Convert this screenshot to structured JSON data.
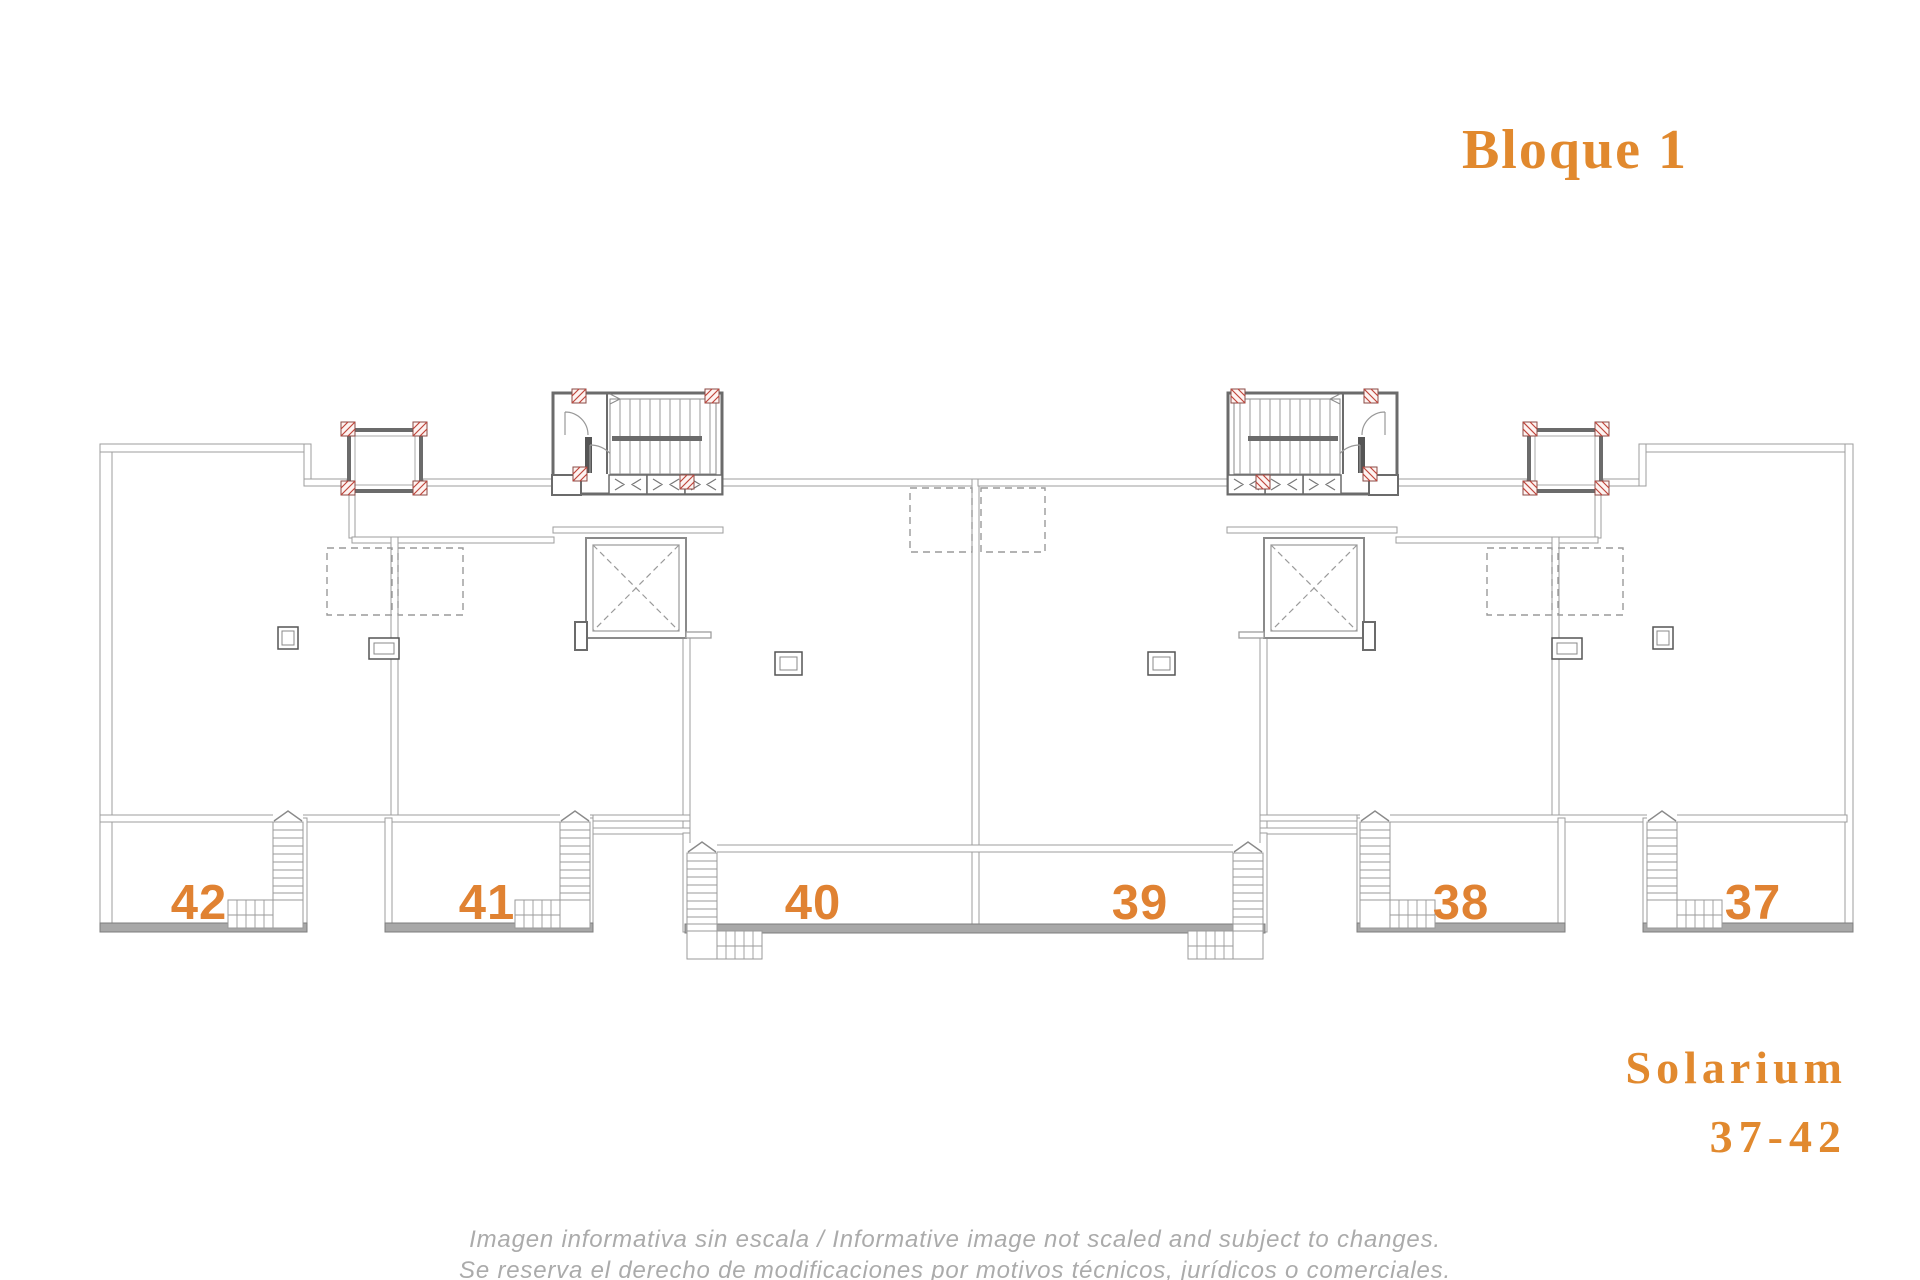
{
  "title_block": {
    "title": "Bloque 1",
    "color": "#E1892E"
  },
  "plan": {
    "units": [
      {
        "number": "42"
      },
      {
        "number": "41"
      },
      {
        "number": "40"
      },
      {
        "number": "39"
      },
      {
        "number": "38"
      },
      {
        "number": "37"
      }
    ],
    "number_color": "#E08232",
    "wall_color": "#9d9d9d",
    "core_wall_color": "#6b6b6b",
    "post_color": "#c0453c"
  },
  "solarium_label": {
    "line1": "Solarium",
    "line2": "37-42",
    "color": "#E1892E"
  },
  "disclaimer": {
    "line1": "Imagen informativa sin escala /  Informative image not scaled and subject to changes.",
    "line2": "Se reserva el derecho de modificaciones por motivos técnicos, jurídicos o comerciales.",
    "color": "#ababab"
  }
}
